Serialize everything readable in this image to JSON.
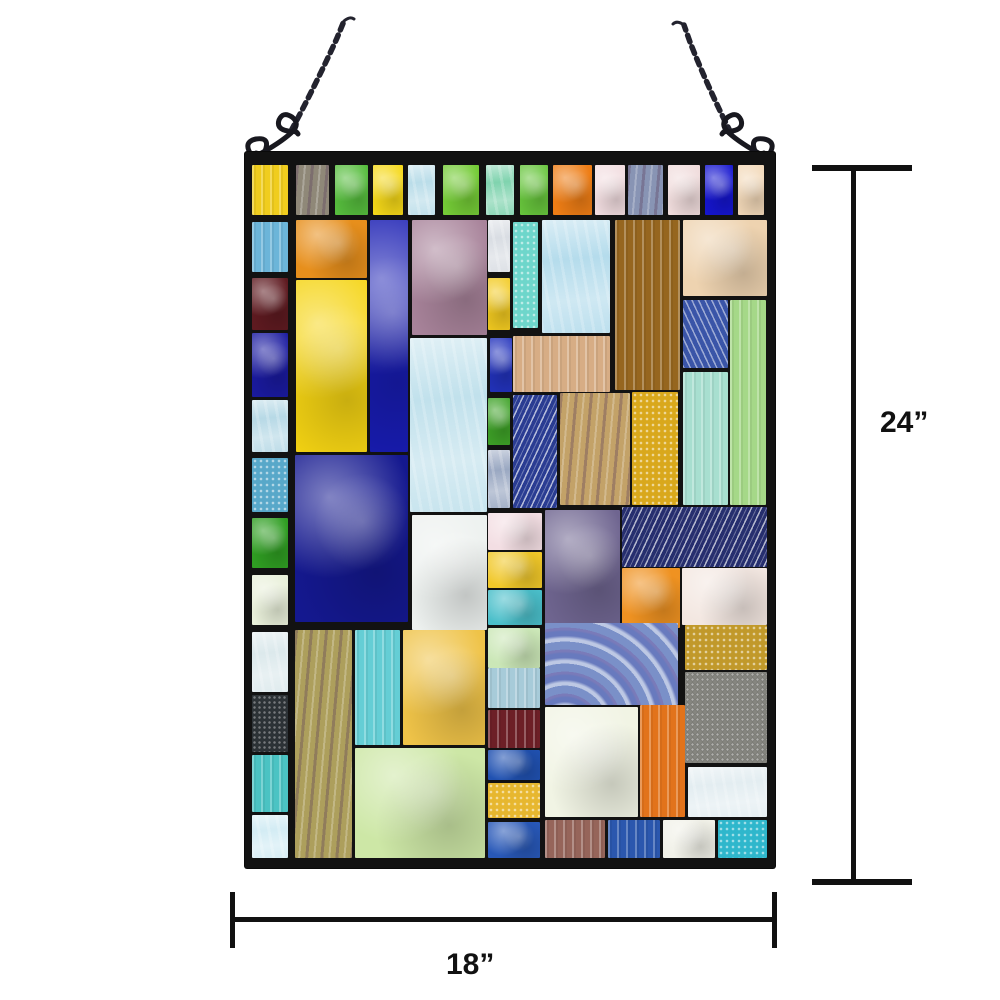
{
  "product": {
    "name": "stained-glass-window-panel",
    "frame_color": "#121212",
    "chain_color": "#23232e"
  },
  "dimensions": {
    "height_label": "24”",
    "width_label": "18”",
    "annotation_color": "#111111"
  },
  "panel": {
    "x": 245,
    "y": 152,
    "w": 530,
    "h": 716,
    "pieces": [
      {
        "x": 7,
        "y": 13,
        "w": 36,
        "h": 50,
        "c": "#f0cd1e",
        "t": "streak"
      },
      {
        "x": 51,
        "y": 13,
        "w": 33,
        "h": 50,
        "c": "#8f8878",
        "t": "streak2"
      },
      {
        "x": 90,
        "y": 13,
        "w": 33,
        "h": 50,
        "c": "#56bd3d",
        "t": "marble"
      },
      {
        "x": 128,
        "y": 13,
        "w": 30,
        "h": 50,
        "c": "#f5d818",
        "t": "marble"
      },
      {
        "x": 163,
        "y": 13,
        "w": 27,
        "h": 50,
        "c": "#badde9",
        "t": "icy"
      },
      {
        "x": 198,
        "y": 13,
        "w": 36,
        "h": 50,
        "c": "#74cb36",
        "t": "marble"
      },
      {
        "x": 241,
        "y": 13,
        "w": 28,
        "h": 50,
        "c": "#7fd3ae",
        "t": "icy"
      },
      {
        "x": 275,
        "y": 13,
        "w": 28,
        "h": 50,
        "c": "#67c53c",
        "t": "marble"
      },
      {
        "x": 308,
        "y": 13,
        "w": 39,
        "h": 50,
        "c": "#ee7d15",
        "t": "marble"
      },
      {
        "x": 350,
        "y": 13,
        "w": 30,
        "h": 50,
        "c": "#f2dde0",
        "t": "marble"
      },
      {
        "x": 383,
        "y": 13,
        "w": 35,
        "h": 50,
        "c": "#8894b4",
        "t": "streak2"
      },
      {
        "x": 423,
        "y": 13,
        "w": 32,
        "h": 50,
        "c": "#f0dcdc",
        "t": "marble"
      },
      {
        "x": 460,
        "y": 13,
        "w": 28,
        "h": 50,
        "c": "#1515cf",
        "t": "marble"
      },
      {
        "x": 493,
        "y": 13,
        "w": 26,
        "h": 50,
        "c": "#f2d8b8",
        "t": "marble"
      },
      {
        "x": 7,
        "y": 70,
        "w": 36,
        "h": 50,
        "c": "#6cb5d9",
        "t": "streak"
      },
      {
        "x": 51,
        "y": 68,
        "w": 71,
        "h": 58,
        "c": "#e78f1c",
        "t": "marble"
      },
      {
        "x": 125,
        "y": 68,
        "w": 38,
        "h": 232,
        "c": "#181cb2",
        "t": "marble"
      },
      {
        "x": 167,
        "y": 68,
        "w": 75,
        "h": 115,
        "c": "#a8839a",
        "t": "marble"
      },
      {
        "x": 243,
        "y": 68,
        "w": 22,
        "h": 52,
        "c": "#d9dde3",
        "t": "icy"
      },
      {
        "x": 268,
        "y": 70,
        "w": 25,
        "h": 106,
        "c": "#6ed6cb",
        "t": "sparkle"
      },
      {
        "x": 297,
        "y": 68,
        "w": 68,
        "h": 113,
        "c": "#b5dcec",
        "t": "icy"
      },
      {
        "x": 370,
        "y": 68,
        "w": 65,
        "h": 170,
        "c": "#96661f",
        "t": "streak"
      },
      {
        "x": 438,
        "y": 68,
        "w": 84,
        "h": 76,
        "c": "#eed3b0",
        "t": "marble"
      },
      {
        "x": 7,
        "y": 126,
        "w": 36,
        "h": 52,
        "c": "#5e1a20",
        "t": "marble"
      },
      {
        "x": 51,
        "y": 128,
        "w": 71,
        "h": 172,
        "c": "#f5d413",
        "t": "marble"
      },
      {
        "x": 243,
        "y": 126,
        "w": 22,
        "h": 52,
        "c": "#f2ca20",
        "t": "marble"
      },
      {
        "x": 438,
        "y": 148,
        "w": 45,
        "h": 68,
        "c": "#3a55a8",
        "t": "wave2"
      },
      {
        "x": 485,
        "y": 148,
        "w": 36,
        "h": 205,
        "c": "#a5d888",
        "t": "streak"
      },
      {
        "x": 7,
        "y": 181,
        "w": 36,
        "h": 64,
        "c": "#1a1aa0",
        "t": "marble"
      },
      {
        "x": 245,
        "y": 186,
        "w": 22,
        "h": 54,
        "c": "#2232bc",
        "t": "marble"
      },
      {
        "x": 268,
        "y": 184,
        "w": 97,
        "h": 56,
        "c": "#d7ad85",
        "t": "streak"
      },
      {
        "x": 165,
        "y": 186,
        "w": 77,
        "h": 174,
        "c": "#c1e1ec",
        "t": "icy"
      },
      {
        "x": 438,
        "y": 220,
        "w": 45,
        "h": 133,
        "c": "#a8dfd0",
        "t": "streak"
      },
      {
        "x": 7,
        "y": 248,
        "w": 36,
        "h": 52,
        "c": "#b7d9e6",
        "t": "icy"
      },
      {
        "x": 7,
        "y": 306,
        "w": 36,
        "h": 54,
        "c": "#58a8c9",
        "t": "sparkle"
      },
      {
        "x": 243,
        "y": 246,
        "w": 22,
        "h": 47,
        "c": "#3ea227",
        "t": "marble"
      },
      {
        "x": 243,
        "y": 298,
        "w": 22,
        "h": 58,
        "c": "#9aa8c2",
        "t": "icy"
      },
      {
        "x": 268,
        "y": 243,
        "w": 44,
        "h": 113,
        "c": "#2a3c92",
        "t": "wave"
      },
      {
        "x": 315,
        "y": 241,
        "w": 70,
        "h": 112,
        "c": "#c3a268",
        "t": "streak2"
      },
      {
        "x": 387,
        "y": 240,
        "w": 46,
        "h": 113,
        "c": "#d9a81c",
        "t": "sparkle"
      },
      {
        "x": 50,
        "y": 303,
        "w": 113,
        "h": 167,
        "c": "#14188f",
        "t": "marble"
      },
      {
        "x": 7,
        "y": 366,
        "w": 36,
        "h": 50,
        "c": "#2f9e22",
        "t": "marble"
      },
      {
        "x": 7,
        "y": 423,
        "w": 36,
        "h": 50,
        "c": "#e9f0da",
        "t": "marble"
      },
      {
        "x": 167,
        "y": 363,
        "w": 75,
        "h": 115,
        "c": "#edf1ef",
        "t": "marble"
      },
      {
        "x": 243,
        "y": 361,
        "w": 54,
        "h": 37,
        "c": "#f3dee3",
        "t": "marble"
      },
      {
        "x": 243,
        "y": 400,
        "w": 54,
        "h": 36,
        "c": "#f1c829",
        "t": "marble"
      },
      {
        "x": 243,
        "y": 438,
        "w": 54,
        "h": 35,
        "c": "#4abfca",
        "t": "marble"
      },
      {
        "x": 300,
        "y": 358,
        "w": 75,
        "h": 115,
        "c": "#6f6590",
        "t": "marble"
      },
      {
        "x": 377,
        "y": 355,
        "w": 145,
        "h": 60,
        "c": "#262e6e",
        "t": "wave"
      },
      {
        "x": 377,
        "y": 416,
        "w": 58,
        "h": 60,
        "c": "#ef9221",
        "t": "marble"
      },
      {
        "x": 437,
        "y": 416,
        "w": 85,
        "h": 57,
        "c": "#f3e7e1",
        "t": "marble"
      },
      {
        "x": 7,
        "y": 480,
        "w": 36,
        "h": 60,
        "c": "#dce9ec",
        "t": "icy"
      },
      {
        "x": 7,
        "y": 543,
        "w": 36,
        "h": 57,
        "c": "#2d3337",
        "t": "sparkle-dark"
      },
      {
        "x": 7,
        "y": 603,
        "w": 36,
        "h": 57,
        "c": "#4bc3c3",
        "t": "streak"
      },
      {
        "x": 7,
        "y": 663,
        "w": 36,
        "h": 43,
        "c": "#d3ecf4",
        "t": "icy"
      },
      {
        "x": 50,
        "y": 478,
        "w": 57,
        "h": 228,
        "c": "#ad9f5c",
        "t": "streak2"
      },
      {
        "x": 110,
        "y": 478,
        "w": 45,
        "h": 115,
        "c": "#65ced5",
        "t": "streak"
      },
      {
        "x": 158,
        "y": 478,
        "w": 82,
        "h": 115,
        "c": "#efc348",
        "t": "marble"
      },
      {
        "x": 110,
        "y": 596,
        "w": 130,
        "h": 110,
        "c": "#cde7a6",
        "t": "marble"
      },
      {
        "x": 243,
        "y": 476,
        "w": 52,
        "h": 40,
        "c": "#cbe7b7",
        "t": "marble"
      },
      {
        "x": 243,
        "y": 516,
        "w": 52,
        "h": 40,
        "c": "#a7cbd9",
        "t": "streak"
      },
      {
        "x": 243,
        "y": 558,
        "w": 52,
        "h": 38,
        "c": "#6d1f26",
        "t": "streak"
      },
      {
        "x": 243,
        "y": 598,
        "w": 52,
        "h": 30,
        "c": "#2051b1",
        "t": "marble"
      },
      {
        "x": 243,
        "y": 631,
        "w": 52,
        "h": 35,
        "c": "#e7b72f",
        "t": "sparkle"
      },
      {
        "x": 243,
        "y": 670,
        "w": 52,
        "h": 36,
        "c": "#2858b8",
        "t": "marble"
      },
      {
        "x": 300,
        "y": 471,
        "w": 133,
        "h": 82,
        "c": "#7a90c8",
        "t": "swirl"
      },
      {
        "x": 440,
        "y": 473,
        "w": 82,
        "h": 45,
        "c": "#c1992a",
        "t": "sparkle"
      },
      {
        "x": 440,
        "y": 520,
        "w": 82,
        "h": 91,
        "c": "#85857f",
        "t": "sparkle-dark"
      },
      {
        "x": 300,
        "y": 555,
        "w": 93,
        "h": 110,
        "c": "#f1f4e4",
        "t": "marble"
      },
      {
        "x": 395,
        "y": 553,
        "w": 45,
        "h": 112,
        "c": "#e2731b",
        "t": "streak"
      },
      {
        "x": 443,
        "y": 615,
        "w": 79,
        "h": 50,
        "c": "#e3edf1",
        "t": "icy"
      },
      {
        "x": 300,
        "y": 668,
        "w": 60,
        "h": 38,
        "c": "#96655a",
        "t": "streak"
      },
      {
        "x": 363,
        "y": 668,
        "w": 52,
        "h": 38,
        "c": "#2b57ae",
        "t": "streak"
      },
      {
        "x": 418,
        "y": 668,
        "w": 52,
        "h": 38,
        "c": "#f1f1e8",
        "t": "marble"
      },
      {
        "x": 473,
        "y": 668,
        "w": 49,
        "h": 38,
        "c": "#2fb7cc",
        "t": "sparkle"
      }
    ]
  }
}
